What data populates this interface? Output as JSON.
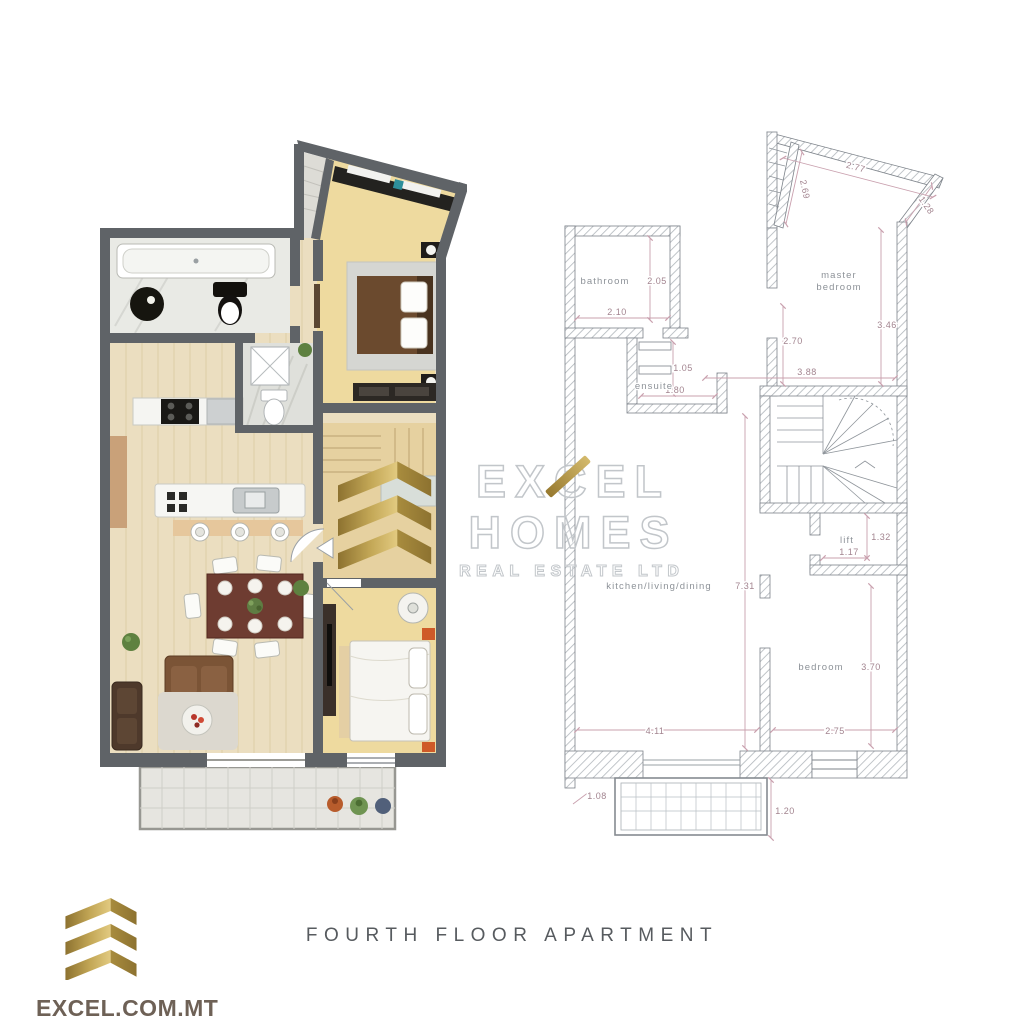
{
  "branding": {
    "watermark": {
      "line1": "EXCEL",
      "line2": "HOMES",
      "line3": "REAL ESTATE LTD"
    },
    "website": "EXCEL.COM.MT",
    "gold": "#b3954a"
  },
  "caption": "FOURTH FLOOR APARTMENT",
  "plan": {
    "labels": {
      "bathroom": "bathroom",
      "master_line1": "master",
      "master_line2": "bedroom",
      "ensuite": "ensuite",
      "lift": "lift",
      "kitchen": "kitchen/living/dining",
      "bedroom": "bedroom"
    },
    "dims": {
      "top": "2.77",
      "top_right": "1.28",
      "top_angled": "2.69",
      "bathroom_h": "2.05",
      "bathroom_w": "2.10",
      "master_inner_h": "2.70",
      "master_h": "3.46",
      "master_w": "3.88",
      "ensuite_h": "1.05",
      "ensuite_w": "1.80",
      "lift_h": "1.32",
      "lift_w": "1.17",
      "living_h": "7.31",
      "living_w": "4.11",
      "bedroom_h": "3.70",
      "bedroom_w": "2.75",
      "balcony_l": "1.08",
      "balcony_r": "1.20"
    }
  }
}
